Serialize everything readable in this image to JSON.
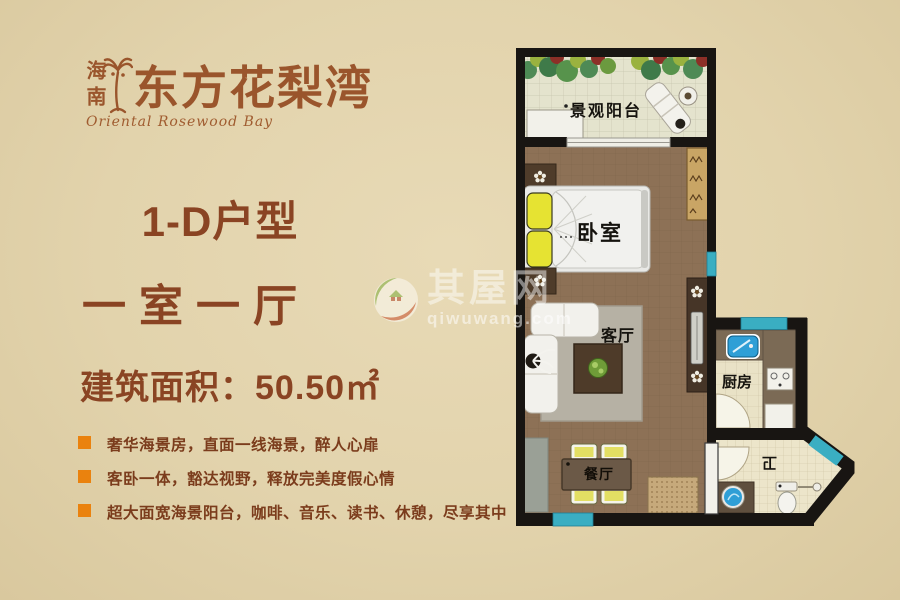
{
  "brand": {
    "region": "海南",
    "name": "东方花梨湾",
    "tagline": "Oriental Rosewood Bay"
  },
  "listing": {
    "unit_type": "1-D户型",
    "layout": "一室一厅",
    "area": "建筑面积：50.50㎡"
  },
  "features": [
    "奢华海景房，直面一线海景，醉人心扉",
    "客卧一体，豁达视野，释放完美度假心情",
    "超大面宽海景阳台，咖啡、音乐、读书、休憩，尽享其中"
  ],
  "floorplan": {
    "rooms": {
      "balcony": "景观阳台",
      "bedroom": "卧室",
      "living": "客厅",
      "kitchen": "厨房",
      "dining": "餐厅",
      "bath": "卫"
    }
  },
  "watermark": {
    "site_name": "其屋网",
    "site_url": "qiwuwang.com"
  },
  "colors": {
    "accent_orange": "#ea820e",
    "brand_brown": "#9a552c",
    "heading_brown": "#8a4423",
    "wall_black": "#181512",
    "window_teal": "#3aaec2"
  }
}
